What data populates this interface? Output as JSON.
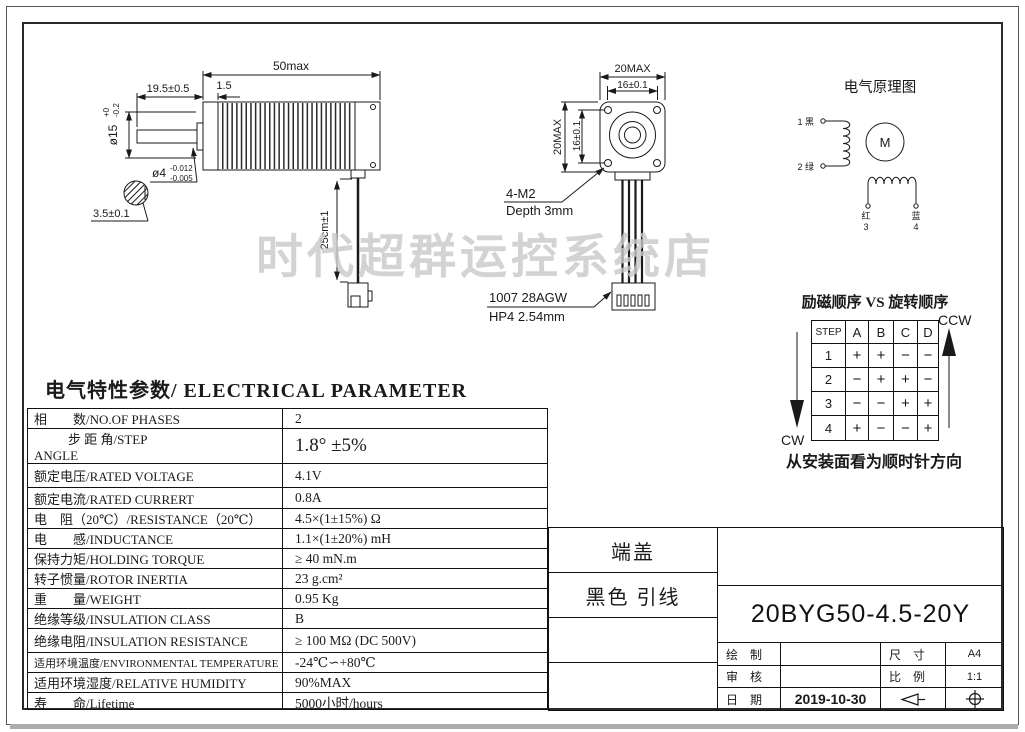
{
  "colors": {
    "line": "#1a1a1a",
    "watermark": "#c9c9c9"
  },
  "watermark": {
    "text": "时代超群运控系统店"
  },
  "side_view": {
    "dim_length": "50max",
    "dim_shaft_len": "19.5±0.5",
    "dim_front_plate": "1.5",
    "dim_pilot_dia": "ø15",
    "dim_pilot_tol_up": "+0",
    "dim_pilot_tol_dn": "-0.2",
    "dim_shaft_dia": "ø4",
    "dim_shaft_tol_up": "-0.012",
    "dim_shaft_tol_dn": "-0.005",
    "dim_flat": "3.5±0.1",
    "dim_cable_len": "25cm±1"
  },
  "front_view": {
    "dim_width": "20MAX",
    "dim_hole_pitch_h": "16±0.1",
    "dim_height": "20MAX",
    "dim_hole_pitch_v": "16±0.1",
    "callout_screws_line1": "4-M2",
    "callout_screws_line2": "Depth 3mm",
    "callout_wire_line1": "1007 28AGW",
    "callout_wire_line2": "HP4 2.54mm"
  },
  "schematic": {
    "title": "电气原理图",
    "lead1": "1 黑",
    "lead2": "2 绿",
    "motor": "M",
    "lead3_color": "红",
    "lead3_no": "3",
    "lead4_color": "蓝",
    "lead4_no": "4"
  },
  "sequence": {
    "title": "励磁顺序 VS 旋转顺序",
    "ccw": "CCW",
    "cw": "CW",
    "note": "从安装面看为顺时针方向",
    "headers": [
      "STEP",
      "A",
      "B",
      "C",
      "D"
    ],
    "rows": [
      [
        "1",
        "+",
        "+",
        "−",
        "−"
      ],
      [
        "2",
        "−",
        "+",
        "+",
        "−"
      ],
      [
        "3",
        "−",
        "−",
        "+",
        "+"
      ],
      [
        "4",
        "+",
        "−",
        "−",
        "+"
      ]
    ]
  },
  "parameters": {
    "title": "电气特性参数/ ELECTRICAL PARAMETER",
    "rows": [
      {
        "label": "相　　数/NO.OF PHASES",
        "value": "2"
      },
      {
        "label": "步 距 角/STEP",
        "label2": "ANGLE",
        "value": "1.8°  ±5%"
      },
      {
        "label": "额定电压/RATED VOLTAGE",
        "value": "4.1V"
      },
      {
        "label": "额定电流/RATED CURRERT",
        "value": "0.8A"
      },
      {
        "label": "电　阻（20℃）/RESISTANCE（20℃）",
        "value": "4.5×(1±15%) Ω"
      },
      {
        "label": "电　　感/INDUCTANCE",
        "value": "1.1×(1±20%) mH"
      },
      {
        "label": "保持力矩/HOLDING TORQUE",
        "value": "≥ 40 mN.m"
      },
      {
        "label": "转子惯量/ROTOR INERTIA",
        "value": "23 g.cm²"
      },
      {
        "label": "重　　量/WEIGHT",
        "value": "0.95 Kg"
      },
      {
        "label": "绝缘等级/INSULATION  CLASS",
        "value": "B"
      },
      {
        "label": "绝缘电阻/INSULATION  RESISTANCE",
        "value": "≥ 100 MΩ (DC 500V)"
      },
      {
        "label": "适用环境温度/ENVIRONMENTAL TEMPERATURE",
        "value": "-24℃∽+80℃"
      },
      {
        "label": "适用环境湿度/RELATIVE HUMIDITY",
        "value": "90%MAX"
      },
      {
        "label": "寿　　命/Lifetime",
        "value": "5000小时/hours"
      }
    ]
  },
  "title_block": {
    "cell_end_cap": "端盖",
    "cell_lead_wire": "黑色 引线",
    "part_number": "20BYG50-4.5-20Y",
    "drawn_label": "绘　制",
    "checked_label": "审　核",
    "date_label": "日　期",
    "date_value": "2019-10-30",
    "size_label": "尺　寸",
    "size_value": "A4",
    "scale_label": "比　例",
    "scale_value": "1:1",
    "symbol_icons": [
      "first-angle-projection-cone-icon",
      "projection-target-icon"
    ]
  }
}
